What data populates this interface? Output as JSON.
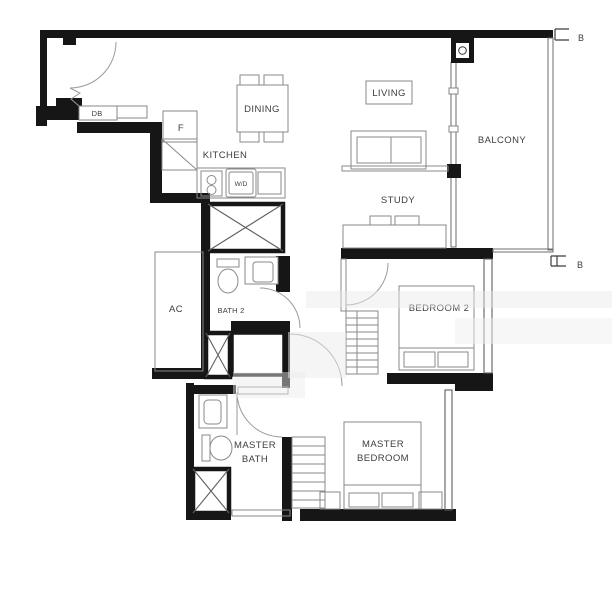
{
  "plan": {
    "rooms": {
      "dining": "DINING",
      "living": "LIVING",
      "balcony": "BALCONY",
      "kitchen": "KITCHEN",
      "study": "STUDY",
      "bedroom2": "BEDROOM 2",
      "ac": "AC",
      "bath2": "BATH 2",
      "master_bath": {
        "line1": "MASTER",
        "line2": "BATH"
      },
      "master_bedroom": {
        "line1": "MASTER",
        "line2": "BEDROOM"
      }
    },
    "fixtures": {
      "db": "DB",
      "fridge": "F",
      "washer_dryer": "W/D"
    },
    "markers": {
      "b_top": "B",
      "b_bottom": "B"
    },
    "colors": {
      "wall": "#161616",
      "furniture_line": "#8a8a8a",
      "label_text": "#3d3d3d",
      "background": "#ffffff"
    }
  }
}
